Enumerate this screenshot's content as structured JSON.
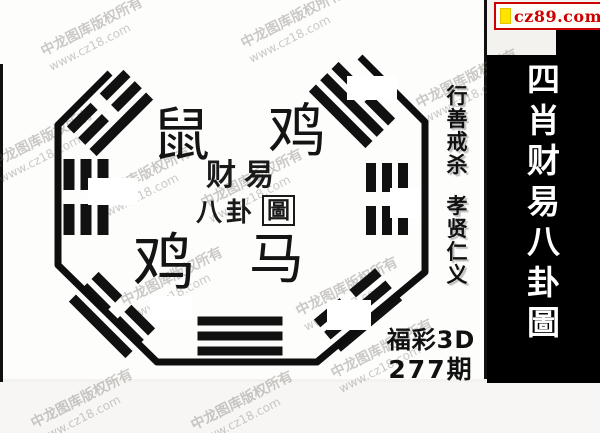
{
  "badge": {
    "text": "cz89.com",
    "text_color": "#cc0000",
    "square_color": "#ffe400"
  },
  "side_panel": {
    "title": "四肖财易八卦圖",
    "bg": "#000000",
    "text_color": "#ffffff"
  },
  "moral_column": {
    "top": "行善戒杀",
    "bottom": "孝贤仁义"
  },
  "issue_block": {
    "lottery": "福彩3D",
    "issue": "277期"
  },
  "bagua": {
    "zodiacs": {
      "top_left": "鼠",
      "top_right": "鸡",
      "bottom_left": "鸡",
      "bottom_right": "马"
    },
    "seal": {
      "line1": "财易",
      "line2_prefix": "八卦",
      "line2_boxed": "圖"
    },
    "octagon_path": "M110,73 L58,125 L58,265 L157,362 L317,362 L425,272 L425,122 L360,57",
    "trigrams": [
      {
        "name": "west",
        "cx": 86,
        "cy": 197,
        "rot": 90,
        "len": 76,
        "t": 11,
        "spacing": 17,
        "gap": 14,
        "lines": [
          "broken",
          "broken",
          "broken"
        ]
      },
      {
        "name": "east",
        "cx": 387,
        "cy": 199,
        "rot": 90,
        "len": 72,
        "t": 10,
        "spacing": 16,
        "gap": 14,
        "lines": [
          "broken",
          "broken",
          "broken"
        ]
      },
      {
        "name": "south",
        "cx": 240,
        "cy": 336,
        "rot": 0,
        "len": 85,
        "t": 9,
        "spacing": 15,
        "gap": 12,
        "lines": [
          "solid",
          "solid",
          "solid"
        ]
      },
      {
        "name": "northwest",
        "cx": 110,
        "cy": 113,
        "rot": -45,
        "len": 80,
        "t": 10,
        "spacing": 16,
        "gap": 13,
        "lines": [
          "broken",
          "broken",
          "solid"
        ]
      },
      {
        "name": "northeast",
        "cx": 352,
        "cy": 105,
        "rot": 45,
        "len": 80,
        "t": 10,
        "spacing": 16,
        "gap": 13,
        "lines": [
          "broken",
          "solid",
          "solid"
        ]
      },
      {
        "name": "southwest",
        "cx": 112,
        "cy": 315,
        "rot": 45,
        "len": 80,
        "t": 10,
        "spacing": 16,
        "gap": 13,
        "lines": [
          "broken",
          "broken",
          "solid"
        ]
      },
      {
        "name": "southeast",
        "cx": 358,
        "cy": 310,
        "rot": -40,
        "len": 80,
        "t": 10,
        "spacing": 16,
        "gap": 13,
        "lines": [
          "broken",
          "solid",
          "solid"
        ]
      }
    ]
  },
  "watermark": {
    "line1": "中龙图库版权所有",
    "line2": "www.cz18.com"
  }
}
